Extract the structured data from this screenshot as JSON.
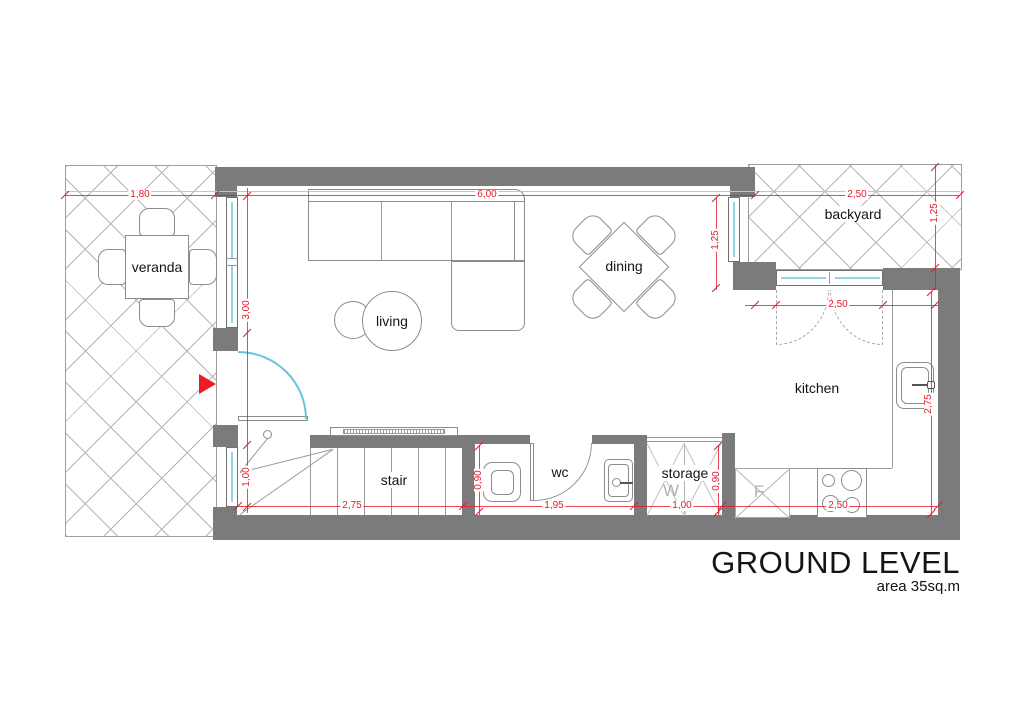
{
  "title": {
    "main": "GROUND LEVEL",
    "sub": "area 35sq.m"
  },
  "rooms": {
    "veranda": "veranda",
    "living": "living",
    "dining": "dining",
    "backyard": "backyard",
    "kitchen": "kitchen",
    "stair": "stair",
    "wc": "wc",
    "storage": "storage"
  },
  "appliances": {
    "washer": "W",
    "fridge": "F"
  },
  "dimensions": {
    "veranda_width": "1,80",
    "living_width": "6,00",
    "backyard_width": "2,50",
    "backyard_depth": "1,25",
    "living_window": "3,00",
    "entry_window": "1,00",
    "dining_window": "1,25",
    "kitchen_door": "2,50",
    "kitchen_depth": "2,75",
    "stair_length": "2,75",
    "wc_width": "1,95",
    "wc_depth": "0,90",
    "storage_width": "1,00",
    "storage_depth": "0,90",
    "kitchen_width": "2,50"
  },
  "colors": {
    "wall": "#7b7b7b",
    "dimension": "#e3192b",
    "window_glass": "#8fd5e7",
    "entrance_arrow": "#ed1c24",
    "hatch_line": "#b5b5b5"
  }
}
